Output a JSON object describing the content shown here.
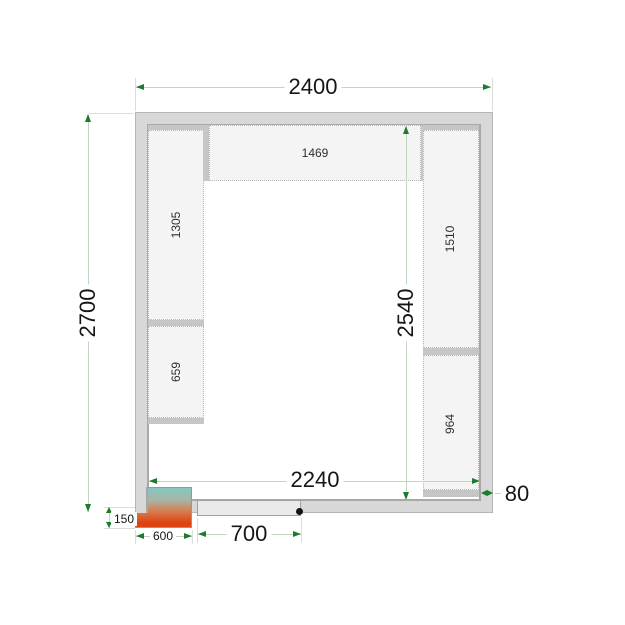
{
  "dims": {
    "outer_width": "2400",
    "outer_depth": "2700",
    "inner_depth": "2540",
    "inner_width": "2240",
    "door_width": "700",
    "unit_width": "600",
    "unit_protrusion": "150",
    "wall_thickness": "80"
  },
  "shelves": {
    "top": "1469",
    "left_upper": "1305",
    "left_lower": "659",
    "right_upper": "1510",
    "right_lower": "964"
  },
  "colors": {
    "arrow_green": "#1e7b2e",
    "dim_line": "#c2d4c2",
    "wall_fill": "#d8d8d8",
    "shelf_fill": "#f4f4f4",
    "shelf_bar": "#c6c6c6",
    "unit_gradient_top": "#85c8c1",
    "unit_gradient_bottom": "#dd4412",
    "door_fill": "#eaeaea"
  }
}
